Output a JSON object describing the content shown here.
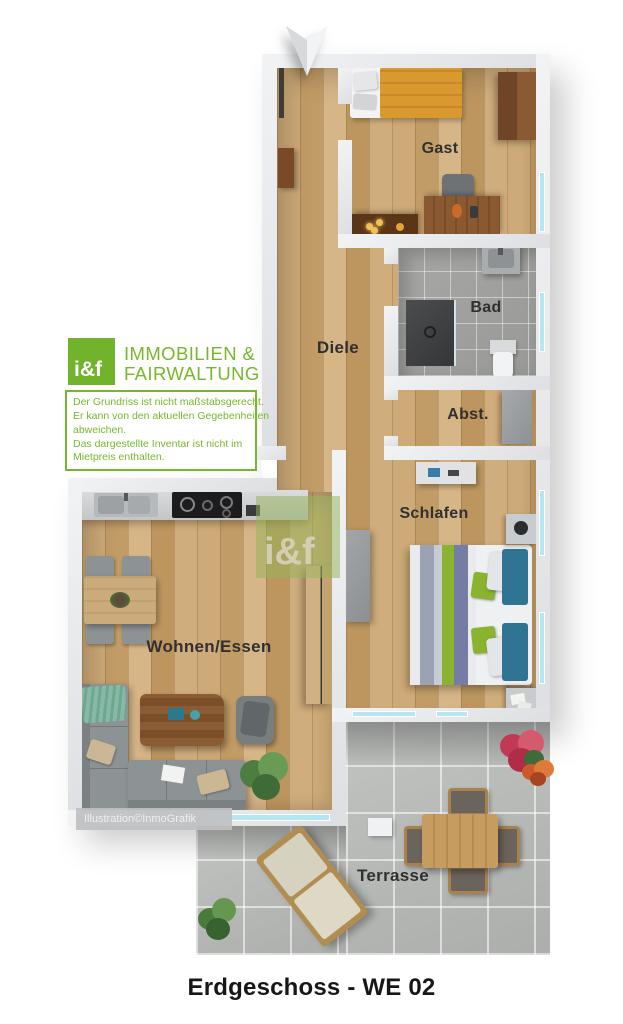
{
  "page": {
    "caption": "Erdgeschoss - WE 02"
  },
  "branding": {
    "logo_short": "i&f",
    "company_line1": "IMMOBILIEN &",
    "company_line2": "FAIRWALTUNG",
    "disclaimer_lines": [
      "Der Grundriss ist nicht maßstabsgerecht.",
      "Er kann von den aktuellen Gegebenheiten",
      "abweichen.",
      "Das dargestellte Inventar ist nicht im",
      "Mietpreis enthalten."
    ]
  },
  "watermarks": {
    "plan_logo": "i&f",
    "credit": "Illustration©InmoGrafik"
  },
  "rooms": {
    "gast": "Gast",
    "bad": "Bad",
    "diele": "Diele",
    "abst": "Abst.",
    "schlafen": "Schlafen",
    "wohnen": "Wohnen/Essen",
    "terrasse": "Terrasse"
  },
  "colors": {
    "brand_green": "#76b82a",
    "wall": "#e7e9eb",
    "wood_floor": "#c9a672",
    "bath_tile": "#a0a09e",
    "terrace_tile": "#b7b9b7",
    "window_glass": "#b5e7f2",
    "label_text": "#303030",
    "bed_orange": "#d9992f",
    "bed_blue": "#2f7492",
    "bed_green": "#8ab32f",
    "sofa_grey": "#8d9294"
  }
}
